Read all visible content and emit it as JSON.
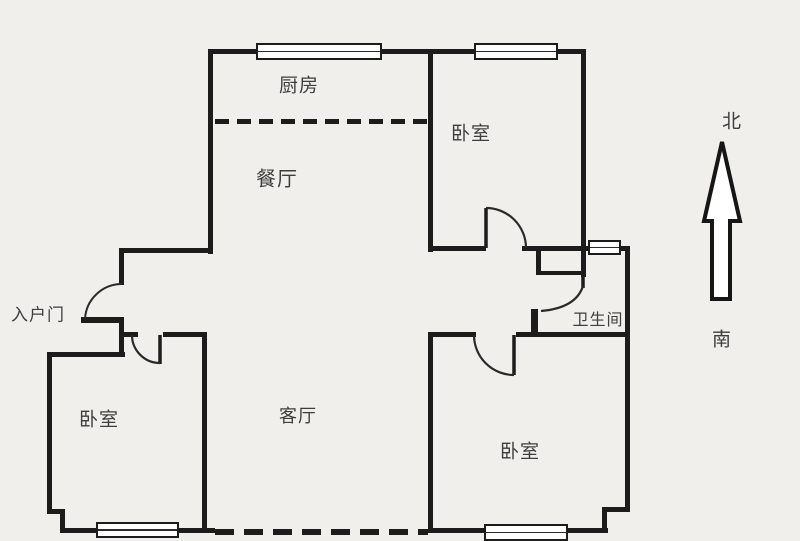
{
  "title": "apartment-floor-plan",
  "colors": {
    "background": "#f0efec",
    "wall": "#1c1c1c",
    "text": "#3e3e3e",
    "window_fill": "#ffffff"
  },
  "rooms": {
    "kitchen": {
      "label": "厨房"
    },
    "bedroom_top_right": {
      "label": "卧室"
    },
    "dining": {
      "label": "餐厅"
    },
    "bathroom": {
      "label": "卫生间"
    },
    "bedroom_bottom_left": {
      "label": "卧室"
    },
    "living": {
      "label": "客厅"
    },
    "bedroom_bottom_right": {
      "label": "卧室"
    }
  },
  "entrance": {
    "label": "入户门"
  },
  "compass": {
    "north": "北",
    "south": "南"
  },
  "symbols": {
    "windows_count": 5,
    "doors_count": 5,
    "open_boundary": "dashed-line"
  }
}
